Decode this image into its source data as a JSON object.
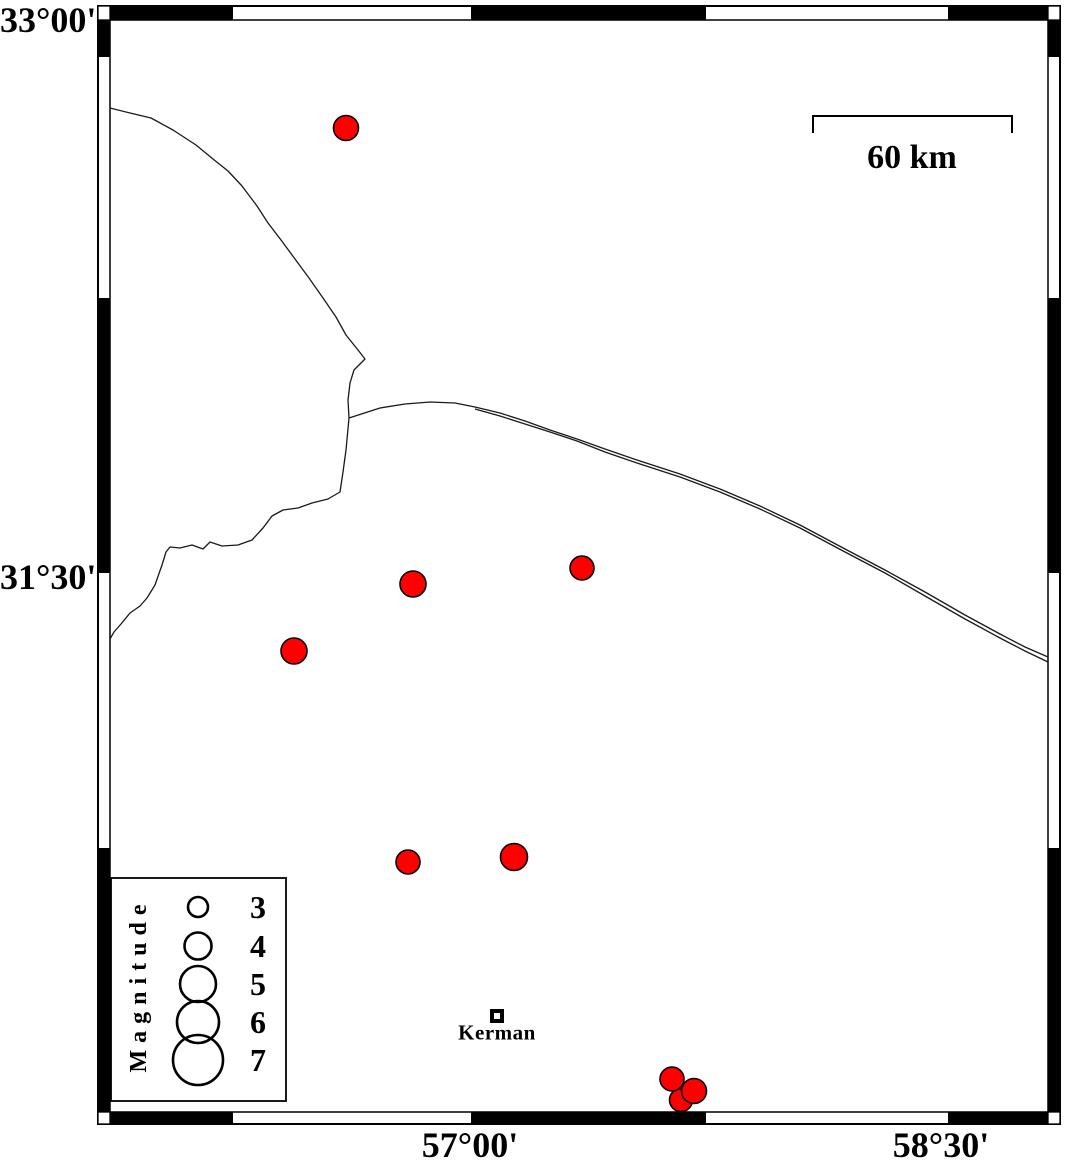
{
  "map": {
    "axis": {
      "left": [
        {
          "text": "33°00'",
          "y": 20
        },
        {
          "text": "31°30'",
          "y": 577
        }
      ],
      "bottom": [
        {
          "text": "57°00'",
          "x": 470
        },
        {
          "text": "58°30'",
          "x": 941
        }
      ]
    },
    "scale_bar": {
      "label": "60 km",
      "x1": 813,
      "x2": 1012,
      "y": 116,
      "tick_drop": 17,
      "label_x": 912,
      "label_y": 158
    },
    "city": {
      "label": "Kerman",
      "x": 497,
      "y": 1016,
      "size": 10
    },
    "legend": {
      "title": "Magnitude",
      "circle_cx": 198,
      "label_cx": 258,
      "box": {
        "x": 111,
        "y": 878,
        "w": 175,
        "h": 223
      },
      "entries": [
        {
          "label": "3",
          "cy": 907,
          "r": 10
        },
        {
          "label": "4",
          "cy": 946,
          "r": 13.5
        },
        {
          "label": "5",
          "cy": 984,
          "r": 18
        },
        {
          "label": "6",
          "cy": 1022,
          "r": 21
        },
        {
          "label": "7",
          "cy": 1060,
          "r": 25
        }
      ]
    },
    "colors": {
      "epicenter_fill": "#ff0000",
      "epicenter_stroke": "#000000",
      "line": "#1a1a1a",
      "frame": "#000000",
      "background": "#ffffff"
    },
    "epicenters": [
      {
        "x": 346,
        "y": 128,
        "r": 12.5
      },
      {
        "x": 413,
        "y": 584,
        "r": 13
      },
      {
        "x": 582,
        "y": 568,
        "r": 12
      },
      {
        "x": 294,
        "y": 651,
        "r": 13
      },
      {
        "x": 408,
        "y": 862,
        "r": 12
      },
      {
        "x": 514,
        "y": 857,
        "r": 13.5
      },
      {
        "x": 681,
        "y": 1100,
        "r": 11.5
      },
      {
        "x": 672,
        "y": 1079,
        "r": 12
      },
      {
        "x": 694,
        "y": 1091,
        "r": 12.5
      }
    ],
    "frame": {
      "outer": {
        "x": 98,
        "y": 6,
        "w": 962,
        "h": 1118
      },
      "inner": {
        "x": 110,
        "y": 20,
        "w": 938,
        "h": 1092
      },
      "top_band": {
        "y": 6,
        "h": 14
      },
      "bottom_band": {
        "y": 1112,
        "h": 12
      },
      "left_band": {
        "x": 98,
        "w": 12
      },
      "right_band": {
        "x": 1048,
        "w": 12
      },
      "black_x": [
        [
          110,
          123
        ],
        [
          471,
          235
        ],
        [
          948,
          100
        ]
      ],
      "black_y": [
        [
          20,
          37
        ],
        [
          298,
          275
        ],
        [
          848,
          264
        ]
      ],
      "corners": [
        [
          98,
          6,
          12,
          14
        ],
        [
          1048,
          6,
          12,
          14
        ],
        [
          98,
          1112,
          12,
          12
        ],
        [
          1048,
          1112,
          12,
          12
        ]
      ]
    },
    "lines": [
      [
        [
          110,
          108
        ],
        [
          130,
          113
        ],
        [
          151,
          118
        ],
        [
          173,
          130
        ],
        [
          196,
          145
        ],
        [
          213,
          159
        ],
        [
          228,
          171
        ],
        [
          242,
          186
        ],
        [
          257,
          206
        ],
        [
          268,
          223
        ],
        [
          281,
          240
        ],
        [
          295,
          259
        ],
        [
          309,
          278
        ],
        [
          323,
          298
        ],
        [
          336,
          317
        ],
        [
          346,
          335
        ],
        [
          358,
          350
        ],
        [
          365,
          359
        ],
        [
          354,
          370
        ],
        [
          350,
          383
        ],
        [
          348,
          400
        ],
        [
          349,
          418
        ]
      ],
      [
        [
          349,
          418
        ],
        [
          380,
          408
        ],
        [
          405,
          404
        ],
        [
          430,
          402
        ],
        [
          455,
          403
        ],
        [
          475,
          407
        ],
        [
          500,
          413
        ],
        [
          525,
          421
        ],
        [
          550,
          430
        ],
        [
          577,
          439
        ],
        [
          605,
          449
        ],
        [
          640,
          461
        ],
        [
          680,
          474
        ],
        [
          720,
          489
        ],
        [
          760,
          506
        ],
        [
          800,
          525
        ],
        [
          845,
          549
        ],
        [
          885,
          570
        ],
        [
          925,
          592
        ],
        [
          965,
          615
        ],
        [
          1000,
          634
        ],
        [
          1025,
          647
        ],
        [
          1048,
          657
        ]
      ],
      [
        [
          475,
          409
        ],
        [
          500,
          416
        ],
        [
          525,
          424
        ],
        [
          550,
          432
        ],
        [
          577,
          441
        ],
        [
          605,
          452
        ],
        [
          640,
          464
        ],
        [
          680,
          477
        ],
        [
          720,
          492
        ],
        [
          760,
          509
        ],
        [
          800,
          528
        ],
        [
          845,
          552
        ],
        [
          885,
          573
        ],
        [
          925,
          596
        ],
        [
          965,
          619
        ],
        [
          1000,
          638
        ],
        [
          1025,
          651
        ],
        [
          1048,
          662
        ]
      ],
      [
        [
          349,
          418
        ],
        [
          346,
          450
        ],
        [
          343,
          472
        ],
        [
          340,
          492
        ],
        [
          328,
          499
        ],
        [
          312,
          503
        ],
        [
          298,
          508
        ],
        [
          283,
          510
        ],
        [
          272,
          516
        ],
        [
          263,
          528
        ],
        [
          252,
          540
        ],
        [
          238,
          545
        ],
        [
          222,
          546
        ],
        [
          210,
          542
        ],
        [
          203,
          549
        ],
        [
          192,
          545
        ],
        [
          180,
          548
        ],
        [
          170,
          547
        ],
        [
          166,
          552
        ],
        [
          162,
          565
        ],
        [
          155,
          585
        ],
        [
          147,
          598
        ],
        [
          140,
          606
        ],
        [
          130,
          613
        ],
        [
          121,
          624
        ],
        [
          114,
          632
        ],
        [
          110,
          639
        ]
      ]
    ]
  }
}
